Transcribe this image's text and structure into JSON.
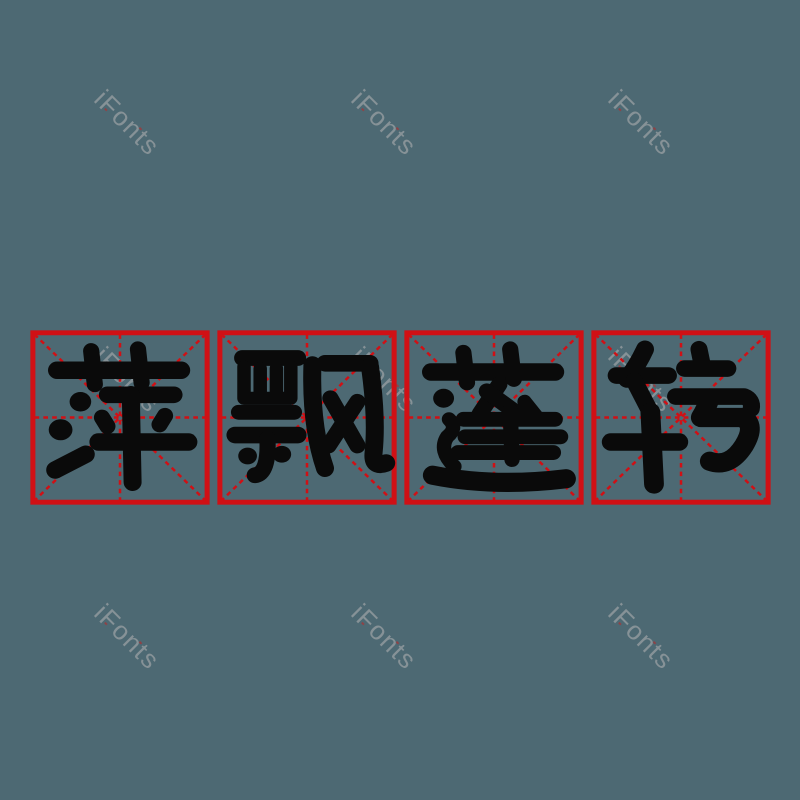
{
  "colors": {
    "background": "#4d6973",
    "grid_red": "#d01015",
    "ink_black": "#0a0a0a",
    "watermark_gray": "#9da2a5"
  },
  "watermark": {
    "text": "iFonts"
  },
  "word": {
    "text": "萍飘蓬转",
    "characters": [
      {
        "char": "萍"
      },
      {
        "char": "飘"
      },
      {
        "char": "蓬"
      },
      {
        "char": "转"
      }
    ]
  }
}
